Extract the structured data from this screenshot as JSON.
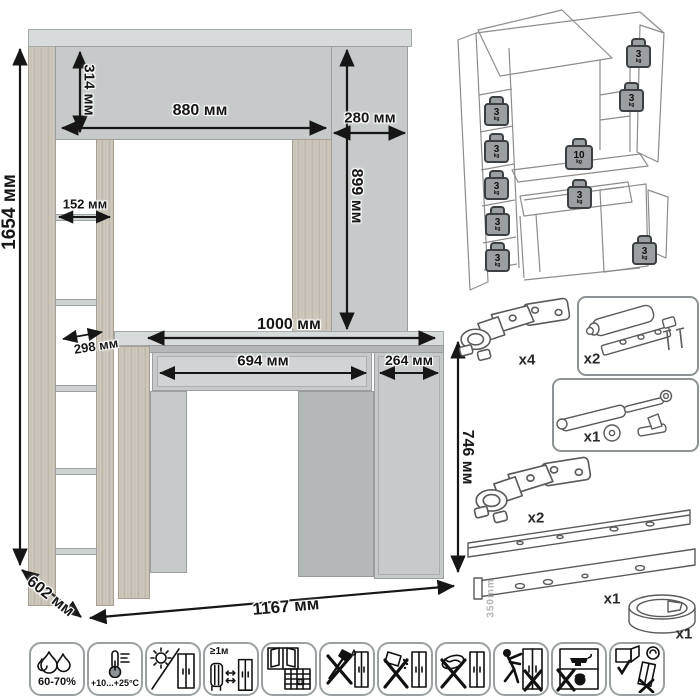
{
  "dims": {
    "overall_height": "1654 мм",
    "hutch_height": "314 мм",
    "hutch_span": "880 мм",
    "column_width": "280 мм",
    "column_height": "899 мм",
    "shelf_width": "152 мм",
    "shelf_depth": "298 мм",
    "desktop_width": "1000 мм",
    "drawer_width": "694 мм",
    "door_width": "264 мм",
    "desk_height": "746 мм",
    "depth": "602 мм",
    "overall_width": "1167 мм"
  },
  "load": {
    "weights": [
      {
        "v": "3",
        "u": "kg"
      },
      {
        "v": "3",
        "u": "kg"
      },
      {
        "v": "3",
        "u": "kg"
      },
      {
        "v": "3",
        "u": "kg"
      },
      {
        "v": "3",
        "u": "kg"
      },
      {
        "v": "3",
        "u": "kg"
      },
      {
        "v": "3",
        "u": "kg"
      },
      {
        "v": "10",
        "u": "kg"
      },
      {
        "v": "3",
        "u": "kg"
      },
      {
        "v": "3",
        "u": "kg"
      }
    ]
  },
  "hardware": {
    "hinge_top_qty": "x4",
    "latch_qty": "x2",
    "gas_lift_qty": "x1",
    "hinge_bottom_qty": "x2",
    "slides_qty": "x1",
    "slides_length": "350mm",
    "grommet_qty": "x1"
  },
  "care": {
    "humidity": "60-70%",
    "temperature": "+10...+25°C",
    "heat_distance": "≥1м",
    "calendar_day": "21"
  },
  "colors": {
    "panel_gray": "#c6caca",
    "panel_light": "#d8dbdc",
    "wood": "#cdc7bd",
    "line": "#161616"
  }
}
